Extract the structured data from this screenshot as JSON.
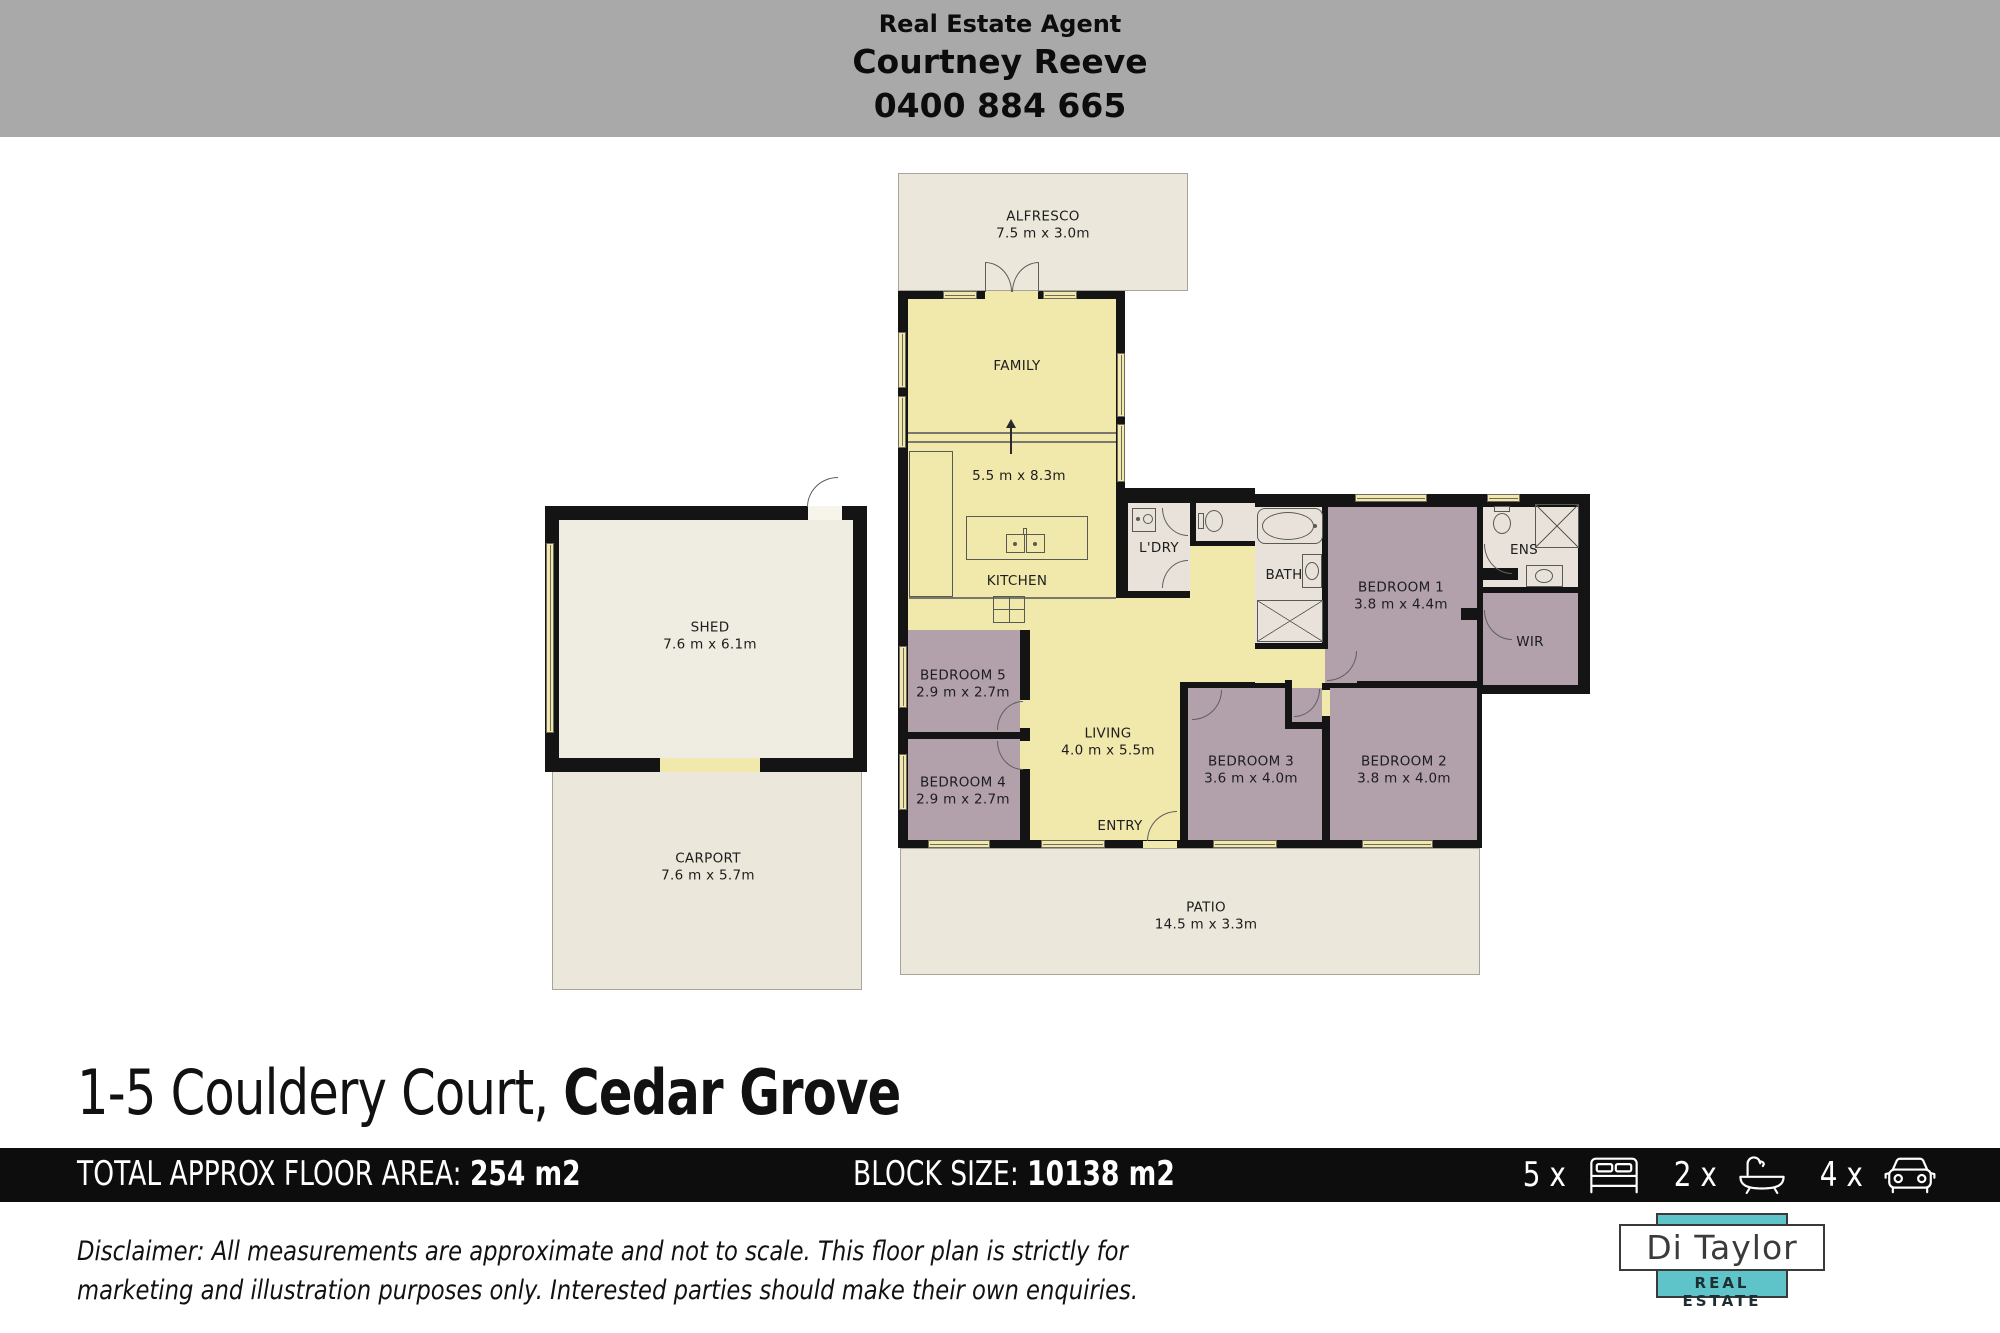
{
  "agent_banner": {
    "heading": "Real Estate Agent",
    "name": "Courtney Reeve",
    "phone": "0400 884 665"
  },
  "plan": {
    "rooms": {
      "alfresco": {
        "label": "ALFRESCO",
        "dims": "7.5 m x 3.0m"
      },
      "family": {
        "label": "FAMILY",
        "dims": "5.5 m x 8.3m"
      },
      "kitchen": {
        "label": "KITCHEN"
      },
      "laundry": {
        "label": "L'DRY"
      },
      "bath": {
        "label": "BATH"
      },
      "bedroom1": {
        "label": "BEDROOM 1",
        "dims": "3.8 m x 4.4m"
      },
      "ensuite": {
        "label": "ENS"
      },
      "wir": {
        "label": "WIR"
      },
      "bedroom5": {
        "label": "BEDROOM 5",
        "dims": "2.9 m x 2.7m"
      },
      "bedroom4": {
        "label": "BEDROOM 4",
        "dims": "2.9 m x 2.7m"
      },
      "living": {
        "label": "LIVING",
        "dims": "4.0 m x 5.5m"
      },
      "bedroom3": {
        "label": "BEDROOM 3",
        "dims": "3.6 m x 4.0m"
      },
      "bedroom2": {
        "label": "BEDROOM 2",
        "dims": "3.8 m x 4.0m"
      },
      "entry": {
        "label": "ENTRY"
      },
      "patio": {
        "label": "PATIO",
        "dims": "14.5 m x 3.3m"
      },
      "shed": {
        "label": "SHED",
        "dims": "7.6 m x 6.1m"
      },
      "carport": {
        "label": "CARPORT",
        "dims": "7.6 m x 5.7m"
      }
    }
  },
  "address": {
    "street": "1-5 Couldery Court, ",
    "suburb": "Cedar Grove"
  },
  "stats_bar": {
    "floor_area_label": "TOTAL APPROX FLOOR AREA: ",
    "floor_area_value": "254 m2",
    "block_label": "BLOCK SIZE: ",
    "block_value": "10138 m2",
    "badges": {
      "beds": "5 x",
      "baths": "2 x",
      "cars": "4 x"
    }
  },
  "disclaimer": {
    "line1": "Disclaimer: All measurements are approximate and not to scale. This floor plan is strictly for",
    "line2": "marketing and illustration purposes only. Interested parties should make their own enquiries."
  },
  "logo": {
    "name": "Di Taylor",
    "tagline": "REAL ESTATE"
  },
  "colors": {
    "header_gray": "#a9a9a9",
    "wall_black": "#141414",
    "interior_yellow": "#f1e8ac",
    "bedroom_mauve": "#b2a1ab",
    "outdoor_beige": "#ebe7da",
    "wet_area": "#e9e2da",
    "bar_black": "#0d0d0d",
    "logo_teal": "#5ec4c9"
  }
}
